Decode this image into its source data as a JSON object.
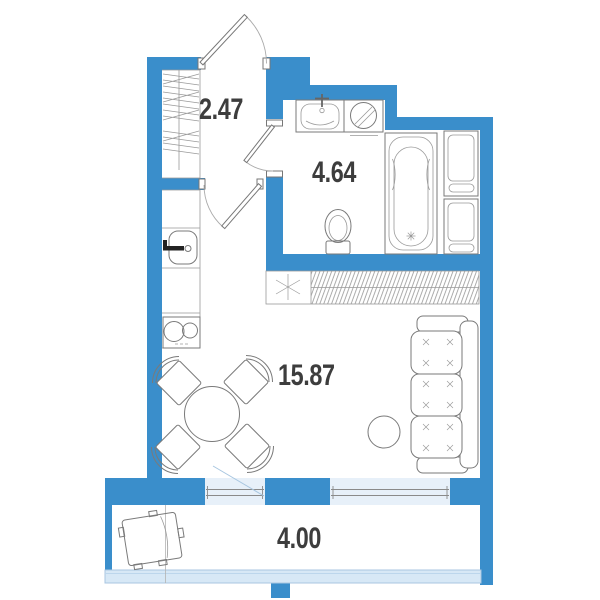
{
  "rooms": {
    "hallway": {
      "area": "2.47"
    },
    "bathroom": {
      "area": "4.64"
    },
    "living": {
      "area": "15.87"
    },
    "balcony": {
      "area": "4.00"
    }
  },
  "colors": {
    "wall": "#3a8ecb",
    "window_fill": "#e7f0f9",
    "railing_fill": "#d7e8f6",
    "light_line": "#a8c6e0",
    "outline": "#7a7a7a",
    "label": "#3d3d3d"
  }
}
